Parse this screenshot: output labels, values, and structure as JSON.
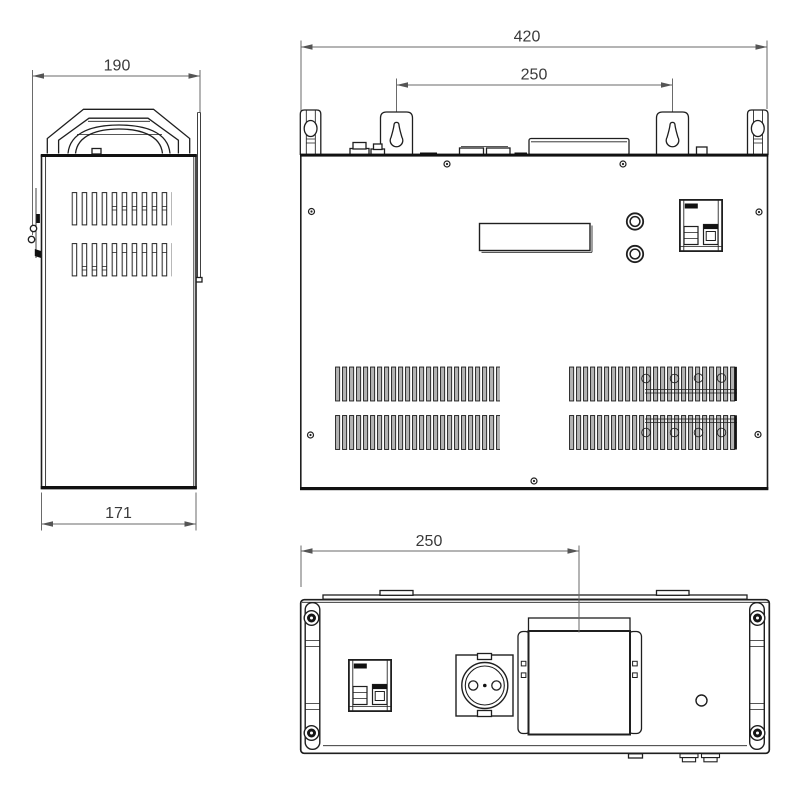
{
  "drawing": {
    "type": "technical-orthographic-views",
    "dimensions": {
      "side_view": {
        "top_width": "190",
        "bottom_width": "171"
      },
      "front_view": {
        "overall_width": "420",
        "mount_hole_spacing": "250"
      },
      "bottom_view": {
        "terminal_box_offset": "250"
      }
    },
    "colors": {
      "object_line": "#1f1f1f",
      "dimension_line": "#6a6a6a",
      "dimension_text": "#3a3a3a",
      "vent_slat_fill": "#b3b3b3",
      "background": "#ffffff"
    }
  }
}
